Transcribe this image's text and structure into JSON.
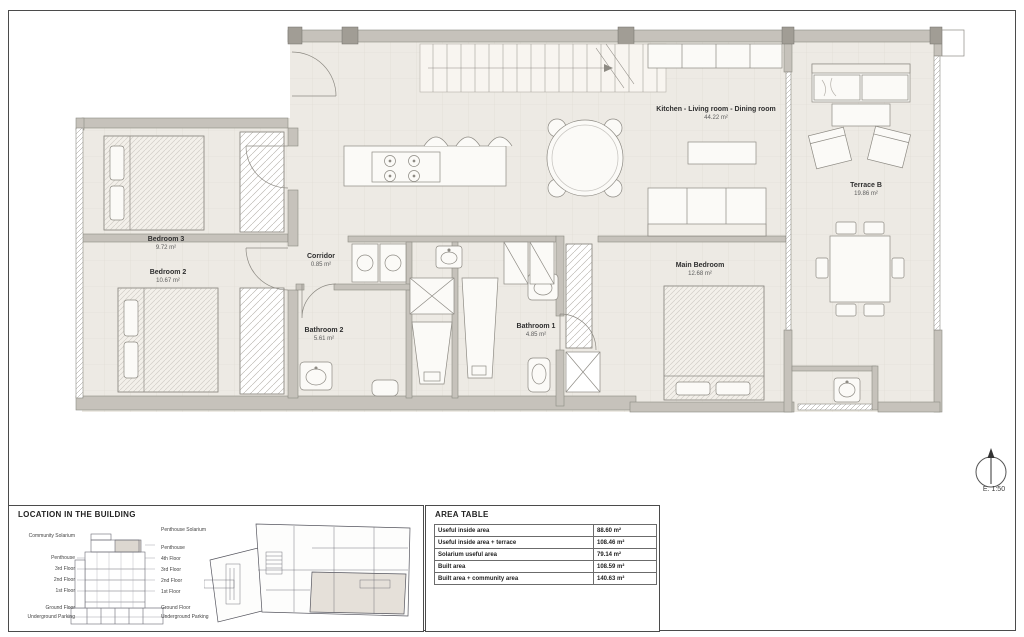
{
  "rooms": {
    "bedroom3": {
      "name": "Bedroom 3",
      "area": "9.72 m²"
    },
    "bedroom2": {
      "name": "Bedroom 2",
      "area": "10.67 m²"
    },
    "corridor": {
      "name": "Corridor",
      "area": "0.85 m²"
    },
    "bathroom2": {
      "name": "Bathroom 2",
      "area": "5.61 m²"
    },
    "bathroom1": {
      "name": "Bathroom 1",
      "area": "4.85 m²"
    },
    "main_bedroom": {
      "name": "Main Bedroom",
      "area": "12.68 m²"
    },
    "kitchen_living_dining": {
      "name": "Kitchen - Living room - Dining room",
      "area": "44.22 m²"
    },
    "terrace_b": {
      "name": "Terrace B",
      "area": "19.86 m²"
    }
  },
  "location_panel": {
    "title": "LOCATION IN THE BUILDING",
    "left_labels": [
      "Community Solarium",
      "Penthouse",
      "3rd Floor",
      "2nd Floor",
      "1st Floor",
      "Ground Floor",
      "Underground Parking"
    ],
    "right_labels": [
      "Penthouse Solarium",
      "Penthouse",
      "4th Floor",
      "3rd Floor",
      "2nd Floor",
      "1st Floor",
      "Ground Floor",
      "Underground Parking"
    ]
  },
  "area_table": {
    "title": "AREA TABLE",
    "rows": [
      {
        "label": "Useful inside area",
        "value": "88.60 m²"
      },
      {
        "label": "Useful inside area + terrace",
        "value": "108.46 m²"
      },
      {
        "label": "Solarium useful area",
        "value": "79.14 m²"
      },
      {
        "label": "Built area",
        "value": "108.59 m²"
      },
      {
        "label": "Built area + community area",
        "value": "140.63 m²"
      }
    ]
  },
  "compass": {
    "scale": "E. 1:50"
  },
  "colors": {
    "wall": "#c6c2bb",
    "column": "#a19d95",
    "floor": "#edeae4",
    "highlight": "#e5e0d9",
    "line": "#8d8a83"
  }
}
